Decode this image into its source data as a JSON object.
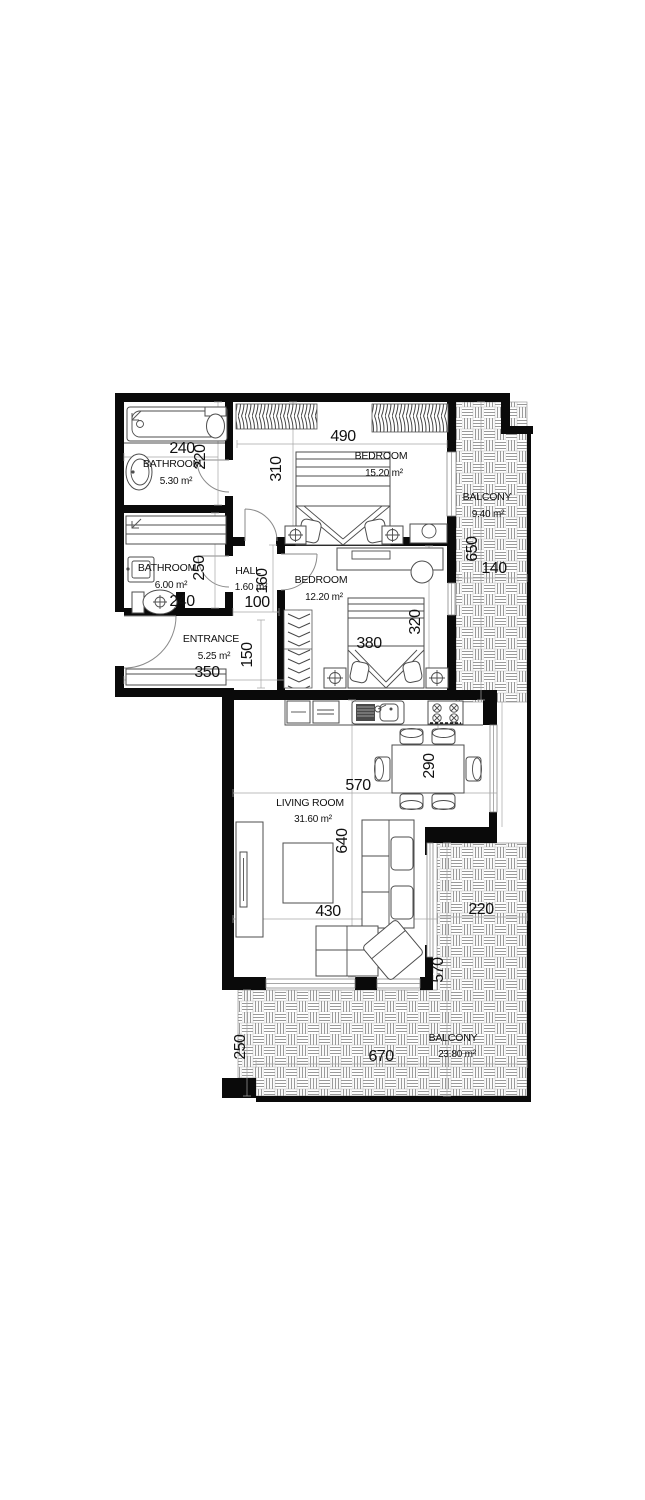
{
  "plan": {
    "rooms": [
      {
        "name": "BATHROOM",
        "area": "5.30 m²"
      },
      {
        "name": "BATHROOM",
        "area": "6.00 m²"
      },
      {
        "name": "HALL",
        "area": "1.60 m²"
      },
      {
        "name": "ENTRANCE",
        "area": "5.25 m²"
      },
      {
        "name": "BEDROOM",
        "area": "15.20 m²"
      },
      {
        "name": "BEDROOM",
        "area": "12.20 m²"
      },
      {
        "name": "LIVING ROOM",
        "area": "31.60 m²"
      },
      {
        "name": "BALCONY",
        "area": "9.40 m²"
      },
      {
        "name": "BALCONY",
        "area": "23.80 m²"
      }
    ],
    "dims": {
      "d240a": "240",
      "d220a": "220",
      "d490": "490",
      "d310": "310",
      "d250": "250",
      "d240b": "240",
      "d100": "100",
      "d160": "160",
      "d350": "350",
      "d150": "150",
      "d380": "380",
      "d320": "320",
      "d650": "650",
      "d140": "140",
      "d570a": "570",
      "d290": "290",
      "d640": "640",
      "d430": "430",
      "d220b": "220",
      "d570b": "570",
      "d250b": "250",
      "d670": "670"
    }
  }
}
